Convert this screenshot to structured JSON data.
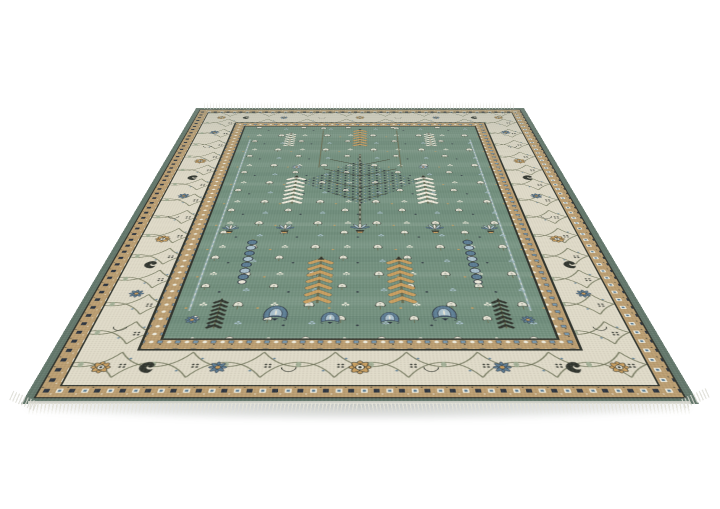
{
  "scene": {
    "type": "product photograph",
    "subject": "Hand-knotted Oushak-style oriental area rug displayed at an angled perspective, front edge toward viewer, on a seamless white studio background",
    "background_description": "plain white, soft gray floor shadow under the front edge"
  },
  "colors": {
    "background": "#ffffff",
    "field": "#74917f",
    "ivory": "#dfdac8",
    "tan": "#bb9e72",
    "gold": "#c89e60",
    "dark": "#32362f",
    "navy": "#2d3540",
    "olive": "#6a6f54",
    "steelblue": "#5e7e95",
    "midblue": "#7d9db1",
    "lightblue": "#aac1cd",
    "sage": "#99a88e",
    "white_motif": "#ece9da",
    "selvage": "#64786c",
    "fringe": "#e3e2d9"
  },
  "rug": {
    "style": "Turkish Oushak tree-of-life design",
    "field": "muted teal-sage field with mirrored cypress chevron trees, a central berry-branch tree, flower urns, blue palmettes and scattered white tulip sprigs",
    "main_border": "ivory band with X-lattice vines, gold eight-petal rosettes, steel-blue daisies, dark paisley leaves and tan crescents",
    "guard_borders": "tan bands with alternating ivory, blue and dark box-and-dot motifs",
    "edge": "dark sage selvage band around the perimeter",
    "fringe": "short ivory warp fringe along the front edge, faint fringe on the far edge",
    "motifs": [
      "gold-rosette",
      "steel-blue-daisy",
      "dark-paisley",
      "tan-crescent",
      "vine-lattice",
      "white-tulip-sprig",
      "clover-dot-sprig",
      "chevron-cypress-tree",
      "blue-bead-column",
      "berry-branch-tree",
      "flower-urn",
      "blue-palmette",
      "box-and-dot-guard",
      "quad-dot-cluster"
    ]
  }
}
